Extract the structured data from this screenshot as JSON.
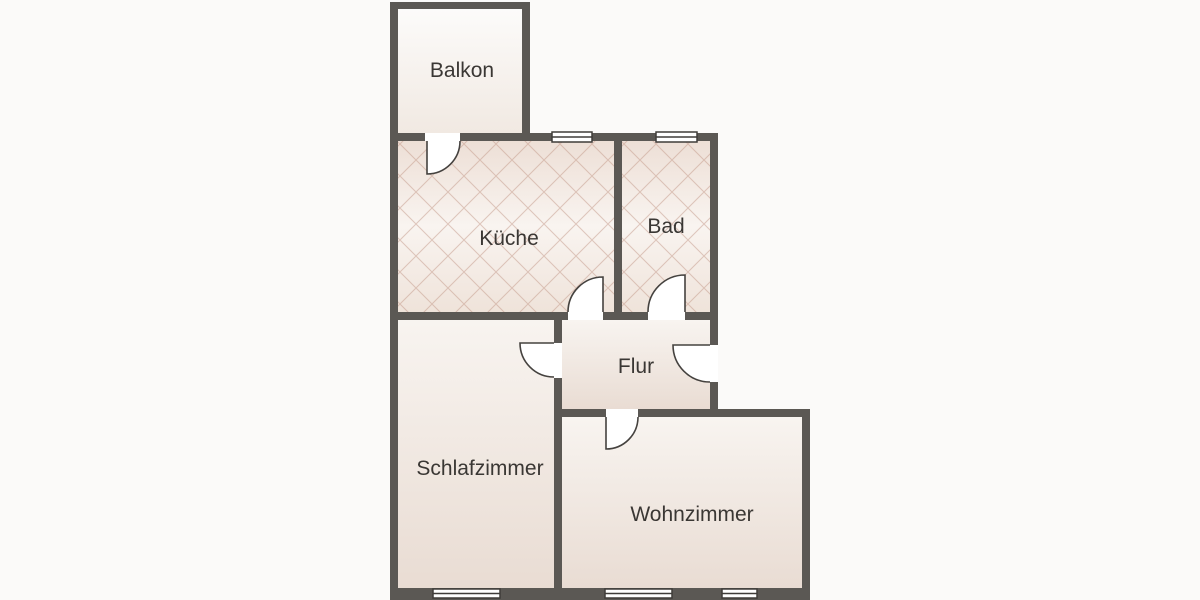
{
  "diagram": {
    "kind": "apartment-floor-plan",
    "rooms": [
      {
        "id": "balkon",
        "label": "Balkon"
      },
      {
        "id": "kueche",
        "label": "Küche"
      },
      {
        "id": "bad",
        "label": "Bad"
      },
      {
        "id": "flur",
        "label": "Flur"
      },
      {
        "id": "schlafzimmer",
        "label": "Schlafzimmer"
      },
      {
        "id": "wohnzimmer",
        "label": "Wohnzimmer"
      }
    ],
    "colors": {
      "wall": "#5b5854",
      "background": "#fbfaf9",
      "door_stroke": "#45423f",
      "window_stroke": "#3f3c39",
      "tile_hatch": "#c49a8a",
      "label_text": "#3a3734",
      "floor_light": "#f8f4f0",
      "floor_dark": "#e9dcd3"
    }
  }
}
